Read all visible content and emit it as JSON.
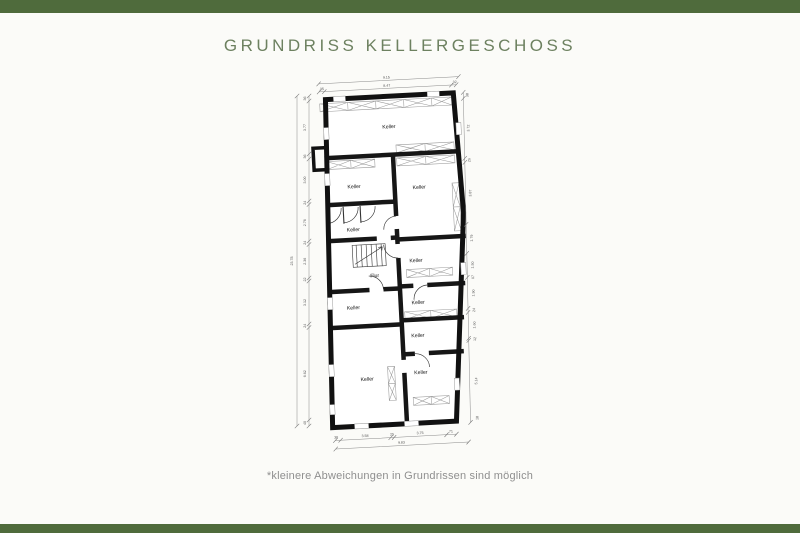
{
  "page": {
    "bar_color": "#4f6b3c",
    "background": "#fbfbf8"
  },
  "header": {
    "title": "GRUNDRISS KELLERGESCHOSS"
  },
  "footer": {
    "disclaimer": "*kleinere Abweichungen in Grundrissen sind möglich"
  },
  "floorplan": {
    "dimension_summary": {
      "top": {
        "total": "9.15",
        "segments": [
          ".35",
          "8.47",
          ".32"
        ]
      },
      "left": {
        "total": "23.78",
        "segments": [
          "36",
          "3.77",
          "36",
          "3.00",
          "24",
          "2.76",
          "24",
          "2.36",
          "22",
          "3.12",
          "24",
          "6.62",
          "40"
        ]
      },
      "right": {
        "segments": [
          "38",
          "3.72",
          "26",
          "3.87",
          "1.79",
          "1.50",
          "07",
          "1.90",
          "24",
          "1.60",
          "12",
          "5.14",
          "18"
        ]
      },
      "bottom": {
        "total": "9.83",
        "segments": [
          "38",
          "3.58",
          "25",
          "3.75",
          "71"
        ]
      }
    },
    "labels": [
      {
        "t": "Keller",
        "x": 120,
        "y": 62,
        "c": "room",
        "g": "rot"
      },
      {
        "t": "Keller",
        "x": 82,
        "y": 120,
        "c": "room",
        "g": "rot"
      },
      {
        "t": "Keller",
        "x": 147,
        "y": 124,
        "c": "room",
        "g": "rot"
      },
      {
        "t": "Keller",
        "x": 79,
        "y": 163,
        "c": "room",
        "g": "rot"
      },
      {
        "t": "Flur",
        "x": 98,
        "y": 210,
        "c": "room",
        "g": "rot"
      },
      {
        "t": "Keller",
        "x": 140,
        "y": 197,
        "c": "room",
        "g": "rot"
      },
      {
        "t": "Keller",
        "x": 75,
        "y": 241,
        "c": "room",
        "g": "rot"
      },
      {
        "t": "Keller",
        "x": 140,
        "y": 239,
        "c": "room",
        "g": "rot"
      },
      {
        "t": "Keller",
        "x": 138,
        "y": 272,
        "c": "room",
        "g": "rot"
      },
      {
        "t": "Keller",
        "x": 85,
        "y": 313,
        "c": "room",
        "g": "rot"
      },
      {
        "t": "Keller",
        "x": 139,
        "y": 309,
        "c": "room",
        "g": "rot"
      },
      {
        "t": "9.15",
        "x": 120,
        "y": 12.2,
        "c": "dim",
        "g": "rot"
      },
      {
        "t": ".35",
        "x": 54.5,
        "y": 20.4,
        "c": "dim",
        "g": "rot"
      },
      {
        "t": "8.47",
        "x": 120,
        "y": 20.4,
        "c": "dim",
        "g": "rot"
      },
      {
        "t": ".32",
        "x": 187.5,
        "y": 20.4,
        "c": "dim",
        "g": "rot"
      },
      {
        "t": "38",
        "x": 51,
        "y": 369,
        "c": "dim",
        "g": "rot"
      },
      {
        "t": "3.58",
        "x": 80,
        "y": 369,
        "c": "dim",
        "g": "rot"
      },
      {
        "t": "25",
        "x": 107,
        "y": 369,
        "c": "dim",
        "g": "rot"
      },
      {
        "t": "3.75",
        "x": 135,
        "y": 369,
        "c": "dim",
        "g": "rot"
      },
      {
        "t": "71",
        "x": 166,
        "y": 369,
        "c": "dim",
        "g": "rot"
      },
      {
        "t": "9.83",
        "x": 116,
        "y": 377.6,
        "c": "dim",
        "g": "rot"
      },
      {
        "t": "23.78",
        "x": 17,
        "y": 195,
        "r": -90,
        "c": "dim",
        "g": "fix"
      },
      {
        "t": "36",
        "x": 30,
        "y": 32.5,
        "r": -90,
        "c": "dim",
        "g": "fix"
      },
      {
        "t": "3.77",
        "x": 30,
        "y": 61.5,
        "r": -90,
        "c": "dim",
        "g": "fix"
      },
      {
        "t": "36",
        "x": 30,
        "y": 90.5,
        "r": -90,
        "c": "dim",
        "g": "fix"
      },
      {
        "t": "3.00",
        "x": 30,
        "y": 114,
        "r": -90,
        "c": "dim",
        "g": "fix"
      },
      {
        "t": "24",
        "x": 30,
        "y": 136.8,
        "r": -90,
        "c": "dim",
        "g": "fix"
      },
      {
        "t": "2.76",
        "x": 30,
        "y": 156.8,
        "r": -90,
        "c": "dim",
        "g": "fix"
      },
      {
        "t": "24",
        "x": 30,
        "y": 176.8,
        "r": -90,
        "c": "dim",
        "g": "fix"
      },
      {
        "t": "2.36",
        "x": 30,
        "y": 195.3,
        "r": -90,
        "c": "dim",
        "g": "fix"
      },
      {
        "t": "22",
        "x": 30,
        "y": 213.5,
        "r": -90,
        "c": "dim",
        "g": "fix"
      },
      {
        "t": "3.12",
        "x": 30,
        "y": 236.5,
        "r": -90,
        "c": "dim",
        "g": "fix"
      },
      {
        "t": "24",
        "x": 30,
        "y": 259.8,
        "r": -90,
        "c": "dim",
        "g": "fix"
      },
      {
        "t": "6.62",
        "x": 30,
        "y": 307.8,
        "r": -90,
        "c": "dim",
        "g": "fix"
      },
      {
        "t": "40",
        "x": 30,
        "y": 357,
        "r": -90,
        "c": "dim",
        "g": "fix"
      },
      {
        "t": "38",
        "x": 201,
        "y": 33,
        "r": -86,
        "c": "dim",
        "g": "rot"
      },
      {
        "t": "3.72",
        "x": 200.3,
        "y": 66,
        "r": -86,
        "c": "dim",
        "g": "rot"
      },
      {
        "t": "26",
        "x": 199.6,
        "y": 98,
        "r": -86,
        "c": "dim",
        "g": "rot"
      },
      {
        "t": "3.87",
        "x": 198.9,
        "y": 131,
        "r": -86,
        "c": "dim",
        "g": "rot"
      },
      {
        "t": "1.79",
        "x": 197.9,
        "y": 176,
        "r": -86,
        "c": "dim",
        "g": "rot"
      },
      {
        "t": "1.50",
        "x": 197.4,
        "y": 203,
        "r": -86,
        "c": "dim",
        "g": "rot"
      },
      {
        "t": "07",
        "x": 197.2,
        "y": 215,
        "r": -86,
        "c": "dim",
        "g": "rot"
      },
      {
        "t": "1.90",
        "x": 196.8,
        "y": 231,
        "r": -86,
        "c": "dim",
        "g": "rot"
      },
      {
        "t": "24",
        "x": 196.5,
        "y": 248,
        "r": -86,
        "c": "dim",
        "g": "rot"
      },
      {
        "t": "1.60",
        "x": 196.1,
        "y": 263,
        "r": -86,
        "c": "dim",
        "g": "rot"
      },
      {
        "t": "12",
        "x": 195.9,
        "y": 277,
        "r": -86,
        "c": "dim",
        "g": "rot"
      },
      {
        "t": "5.14",
        "x": 194.9,
        "y": 319,
        "r": -86,
        "c": "dim",
        "g": "rot"
      },
      {
        "t": "18",
        "x": 194,
        "y": 356,
        "r": -86,
        "c": "dim",
        "g": "rot"
      }
    ]
  }
}
